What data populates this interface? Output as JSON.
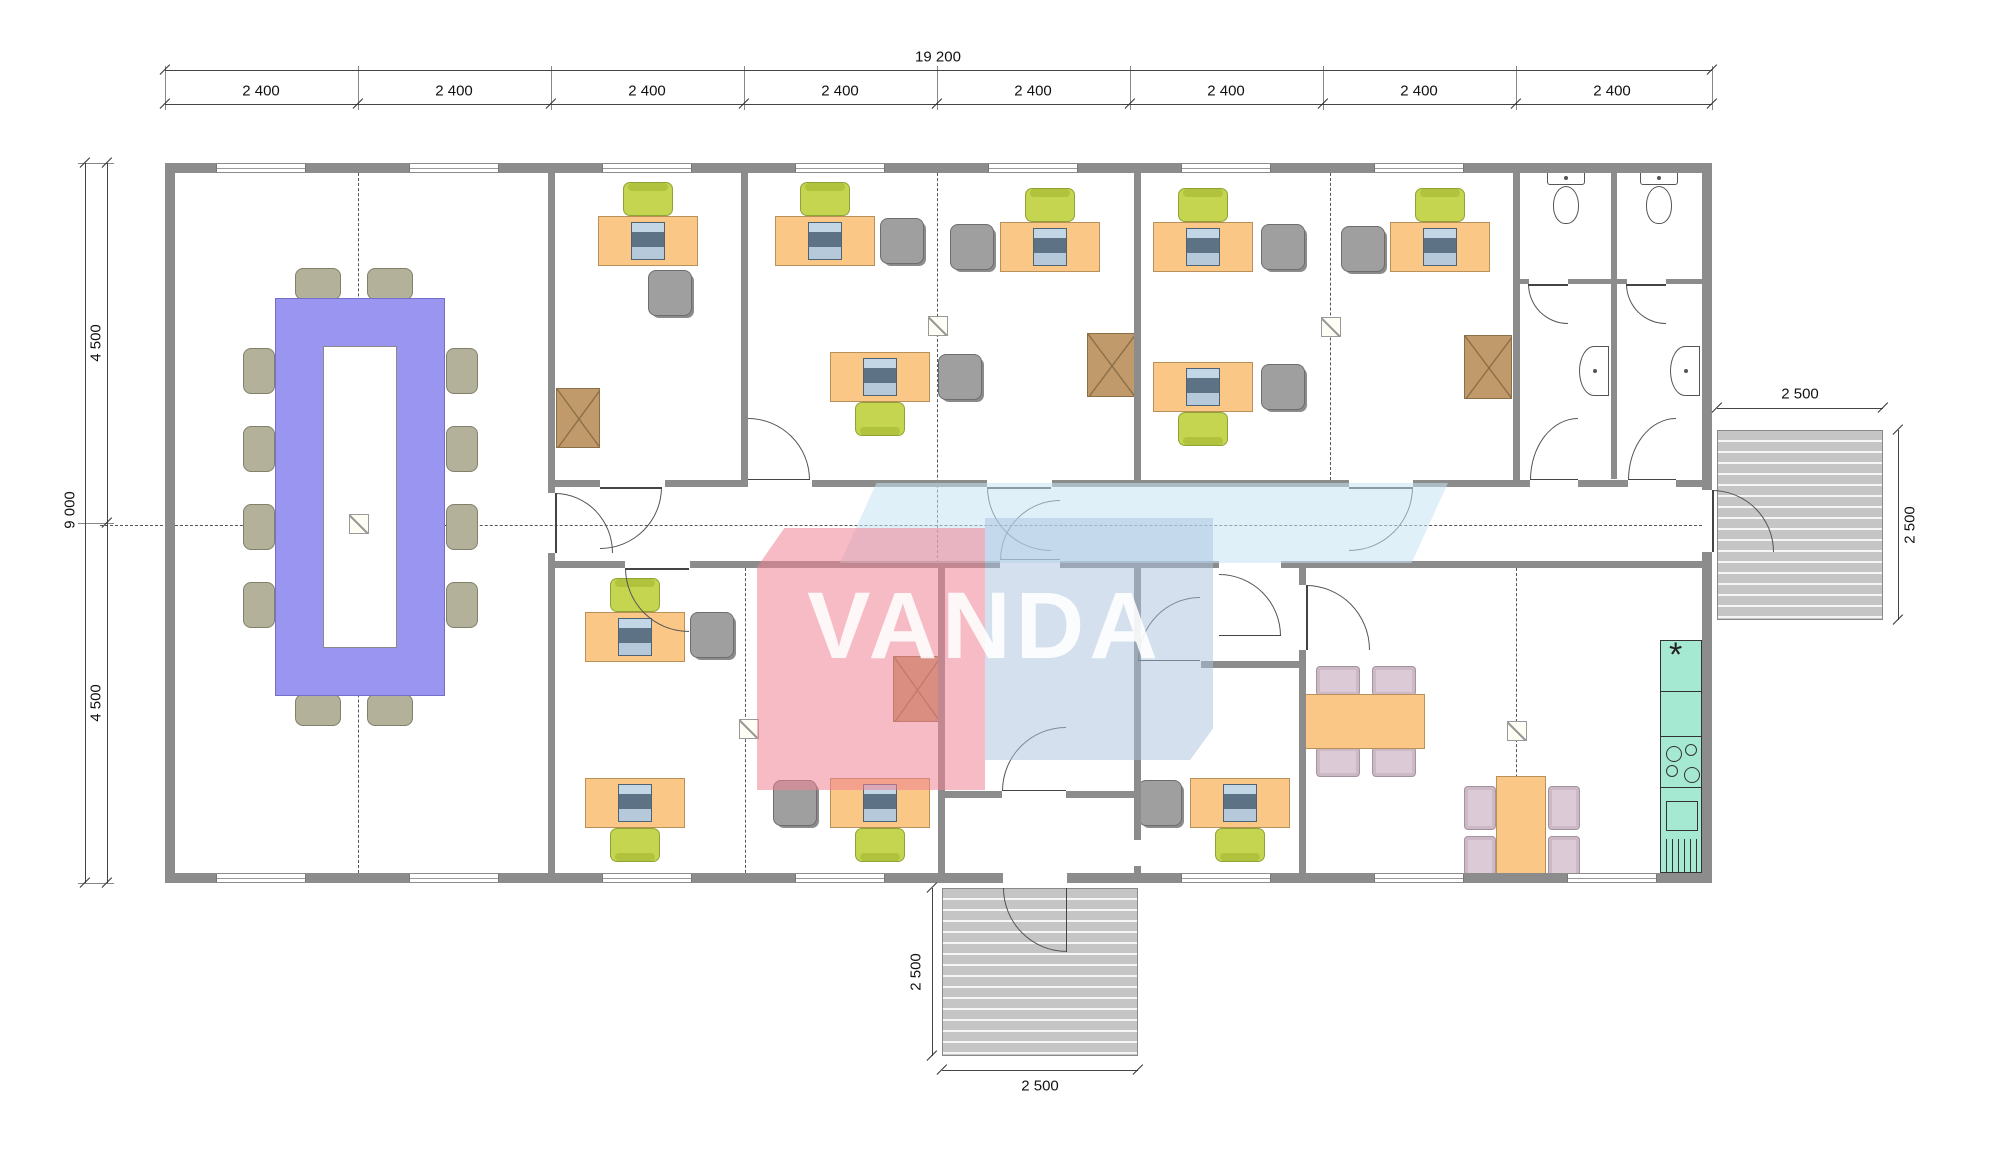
{
  "watermark": {
    "text": "VANDA",
    "accent_red": "#ef8494",
    "accent_blue": "#a9c2de",
    "accent_lightblue": "#c5e4f4"
  },
  "dimensions": {
    "top_total": "19 200",
    "top_segments": [
      "2 400",
      "2 400",
      "2 400",
      "2 400",
      "2 400",
      "2 400",
      "2 400",
      "2 400"
    ],
    "left_total": "9 000",
    "left_segments": [
      "4 500",
      "4 500"
    ],
    "right_porch_width": "2 500",
    "right_porch_depth": "2 500",
    "bottom_porch_depth": "2 500",
    "bottom_porch_width": "2 500",
    "labels": [
      {
        "text": "19 200",
        "x": 938,
        "y": 57,
        "rot": 0,
        "name": "dim-total-width"
      },
      {
        "text": "2 400",
        "x": 261,
        "y": 91,
        "rot": 0,
        "name": "dim-module"
      },
      {
        "text": "2 400",
        "x": 454,
        "y": 91,
        "rot": 0,
        "name": "dim-module"
      },
      {
        "text": "2 400",
        "x": 647,
        "y": 91,
        "rot": 0,
        "name": "dim-module"
      },
      {
        "text": "2 400",
        "x": 840,
        "y": 91,
        "rot": 0,
        "name": "dim-module"
      },
      {
        "text": "2 400",
        "x": 1033,
        "y": 91,
        "rot": 0,
        "name": "dim-module"
      },
      {
        "text": "2 400",
        "x": 1226,
        "y": 91,
        "rot": 0,
        "name": "dim-module"
      },
      {
        "text": "2 400",
        "x": 1419,
        "y": 91,
        "rot": 0,
        "name": "dim-module"
      },
      {
        "text": "2 400",
        "x": 1612,
        "y": 91,
        "rot": 0,
        "name": "dim-module"
      },
      {
        "text": "9 000",
        "x": 70,
        "y": 510,
        "rot": 1,
        "name": "dim-total-depth"
      },
      {
        "text": "4 500",
        "x": 96,
        "y": 343,
        "rot": 1,
        "name": "dim-half-depth"
      },
      {
        "text": "4 500",
        "x": 96,
        "y": 703,
        "rot": 1,
        "name": "dim-half-depth"
      },
      {
        "text": "2 500",
        "x": 1800,
        "y": 394,
        "rot": 0,
        "name": "dim-right-porch"
      },
      {
        "text": "2 500",
        "x": 1910,
        "y": 525,
        "rot": 1,
        "name": "dim-right-porch"
      },
      {
        "text": "2 500",
        "x": 916,
        "y": 972,
        "rot": 1,
        "name": "dim-bottom-porch"
      },
      {
        "text": "2 500",
        "x": 1040,
        "y": 1086,
        "rot": 0,
        "name": "dim-bottom-porch"
      }
    ],
    "lines": [
      {
        "x": 165,
        "y": 70,
        "len": 1547,
        "dir": "h",
        "ticks": [
          165,
          1712
        ]
      },
      {
        "x": 165,
        "y": 104,
        "len": 1547,
        "dir": "h",
        "ticks": [
          165,
          358,
          551,
          744,
          937,
          1130,
          1323,
          1516,
          1712
        ]
      },
      {
        "x": 85,
        "y": 163,
        "len": 720,
        "dir": "v",
        "ticks": [
          163,
          883
        ]
      },
      {
        "x": 107,
        "y": 163,
        "len": 720,
        "dir": "v",
        "ticks": [
          163,
          523,
          883
        ]
      },
      {
        "x": 1717,
        "y": 408,
        "len": 166,
        "dir": "h",
        "ticks": [
          1717,
          1883
        ]
      },
      {
        "x": 1898,
        "y": 430,
        "len": 190,
        "dir": "v",
        "ticks": [
          430,
          620
        ]
      },
      {
        "x": 932,
        "y": 888,
        "len": 168,
        "dir": "v",
        "ticks": [
          888,
          1056
        ]
      },
      {
        "x": 942,
        "y": 1070,
        "len": 196,
        "dir": "h",
        "ticks": [
          942,
          1138
        ]
      }
    ],
    "stubs_top_x": [
      165,
      358,
      551,
      744,
      937,
      1130,
      1323,
      1516,
      1712
    ],
    "stubs_left_y": [
      163,
      523,
      883
    ]
  },
  "plan": {
    "walls": [
      [
        165,
        163,
        1547,
        10
      ],
      [
        165,
        873,
        1547,
        10
      ],
      [
        165,
        163,
        10,
        720
      ],
      [
        1702,
        163,
        10,
        720
      ],
      [
        548,
        163,
        7,
        330
      ],
      [
        548,
        553,
        7,
        330
      ],
      [
        741,
        163,
        7,
        317
      ],
      [
        1134,
        163,
        7,
        317
      ],
      [
        1513,
        163,
        7,
        317
      ],
      [
        1611,
        163,
        6,
        316
      ],
      [
        555,
        480,
        45,
        7
      ],
      [
        665,
        480,
        83,
        7
      ],
      [
        812,
        480,
        175,
        7
      ],
      [
        1052,
        480,
        297,
        7
      ],
      [
        1413,
        480,
        117,
        7
      ],
      [
        1578,
        480,
        50,
        7
      ],
      [
        1676,
        480,
        36,
        7
      ],
      [
        555,
        561,
        70,
        7
      ],
      [
        690,
        561,
        310,
        7
      ],
      [
        1060,
        561,
        159,
        7
      ],
      [
        1281,
        561,
        431,
        7
      ],
      [
        938,
        568,
        7,
        315
      ],
      [
        1134,
        568,
        7,
        272
      ],
      [
        1134,
        866,
        7,
        17
      ],
      [
        1299,
        568,
        7,
        17
      ],
      [
        1299,
        650,
        7,
        233
      ],
      [
        1201,
        661,
        98,
        7
      ],
      [
        945,
        791,
        57,
        7
      ],
      [
        1066,
        791,
        68,
        7
      ],
      [
        1519,
        279,
        10,
        5
      ],
      [
        1568,
        279,
        43,
        5
      ],
      [
        1617,
        279,
        10,
        5
      ],
      [
        1666,
        279,
        45,
        5
      ]
    ],
    "gaps": [
      [
        1003,
        873,
        64,
        10
      ],
      [
        1702,
        490,
        10,
        62
      ]
    ],
    "window_w": 90,
    "windows_top": [
      216,
      409,
      602,
      795,
      988,
      1181,
      1374
    ],
    "windows_bottom": [
      216,
      409,
      602,
      795,
      1181,
      1374,
      1567
    ],
    "dashed": [
      [
        358,
        163,
        720,
        "v"
      ],
      [
        937,
        163,
        400,
        "v"
      ],
      [
        1330,
        163,
        317,
        "v"
      ],
      [
        745,
        568,
        315,
        "v"
      ],
      [
        1516,
        568,
        315,
        "v"
      ],
      [
        100,
        525,
        1612,
        "h"
      ]
    ],
    "markers": [
      [
        349,
        514
      ],
      [
        928,
        316
      ],
      [
        1321,
        317
      ],
      [
        739,
        719
      ],
      [
        1507,
        721
      ]
    ],
    "doors": [
      [
        555,
        493,
        58,
        60,
        "tr",
        "left"
      ],
      [
        600,
        487,
        62,
        62,
        "br",
        "top"
      ],
      [
        748,
        418,
        62,
        62,
        "tr",
        "bottom"
      ],
      [
        987,
        487,
        64,
        64,
        "bl",
        "top"
      ],
      [
        1349,
        487,
        64,
        64,
        "br",
        "top"
      ],
      [
        1530,
        418,
        48,
        62,
        "tl",
        "bottom"
      ],
      [
        1628,
        418,
        48,
        62,
        "tl",
        "bottom"
      ],
      [
        1003,
        888,
        64,
        64,
        "bl",
        "right"
      ],
      [
        1002,
        727,
        64,
        64,
        "tl",
        "bottom"
      ],
      [
        1138,
        597,
        62,
        64,
        "tl",
        "bottom"
      ],
      [
        1306,
        585,
        64,
        65,
        "tr",
        "left"
      ],
      [
        1712,
        490,
        62,
        62,
        "tr",
        "left"
      ],
      [
        625,
        568,
        64,
        64,
        "bl",
        "top"
      ],
      [
        1000,
        500,
        60,
        60,
        "tl",
        "bottom"
      ],
      [
        1219,
        574,
        62,
        62,
        "tr",
        "bottom"
      ],
      [
        1528,
        284,
        40,
        40,
        "bl",
        "top"
      ],
      [
        1626,
        284,
        40,
        40,
        "bl",
        "top"
      ]
    ],
    "desk_size": [
      100,
      50
    ],
    "desks": [
      [
        598,
        216
      ],
      [
        775,
        216
      ],
      [
        1000,
        222
      ],
      [
        1153,
        222
      ],
      [
        1390,
        222
      ],
      [
        830,
        352
      ],
      [
        1153,
        362
      ],
      [
        585,
        612
      ],
      [
        585,
        778
      ],
      [
        830,
        778
      ],
      [
        1190,
        778
      ]
    ],
    "green_chairs": [
      [
        623,
        182,
        "u"
      ],
      [
        800,
        182,
        "u"
      ],
      [
        1025,
        188,
        "u"
      ],
      [
        1178,
        188,
        "u"
      ],
      [
        1415,
        188,
        "u"
      ],
      [
        855,
        402,
        "d"
      ],
      [
        1178,
        412,
        "d"
      ],
      [
        610,
        578,
        "u"
      ],
      [
        610,
        828,
        "d"
      ],
      [
        855,
        828,
        "d"
      ],
      [
        1215,
        828,
        "d"
      ]
    ],
    "gray_chairs": [
      [
        648,
        270
      ],
      [
        880,
        218
      ],
      [
        950,
        224
      ],
      [
        1261,
        224
      ],
      [
        1341,
        226
      ],
      [
        938,
        354
      ],
      [
        1261,
        364
      ],
      [
        690,
        612
      ],
      [
        773,
        780
      ],
      [
        1138,
        780
      ]
    ],
    "cabinets": [
      [
        556,
        388,
        44,
        60
      ],
      [
        1087,
        333,
        48,
        64
      ],
      [
        1464,
        335,
        48,
        64
      ],
      [
        893,
        656,
        47,
        66
      ]
    ],
    "conference": {
      "outer": [
        275,
        298,
        170,
        398
      ],
      "inner": [
        323,
        346,
        74,
        302
      ],
      "chairs": [
        [
          295,
          268,
          46,
          32
        ],
        [
          367,
          268,
          46,
          32
        ],
        [
          295,
          694,
          46,
          32
        ],
        [
          367,
          694,
          46,
          32
        ],
        [
          243,
          348,
          32,
          46
        ],
        [
          243,
          426,
          32,
          46
        ],
        [
          243,
          504,
          32,
          46
        ],
        [
          243,
          582,
          32,
          46
        ],
        [
          446,
          348,
          32,
          46
        ],
        [
          446,
          426,
          32,
          46
        ],
        [
          446,
          504,
          32,
          46
        ],
        [
          446,
          582,
          32,
          46
        ]
      ]
    },
    "break_tables": [
      [
        1303,
        694,
        122,
        55
      ],
      [
        1496,
        776,
        50,
        104
      ]
    ],
    "pink_chairs": [
      [
        1316,
        666,
        44,
        30
      ],
      [
        1372,
        666,
        44,
        30
      ],
      [
        1316,
        747,
        44,
        30
      ],
      [
        1372,
        747,
        44,
        30
      ],
      [
        1464,
        786,
        32,
        44
      ],
      [
        1464,
        836,
        32,
        44
      ],
      [
        1548,
        786,
        32,
        44
      ],
      [
        1548,
        836,
        32,
        44
      ]
    ],
    "kitchen": {
      "counter": [
        1660,
        640,
        42,
        233
      ],
      "lines": [
        50,
        95,
        146
      ],
      "burners": [
        [
          5,
          105,
          16
        ],
        [
          24,
          103,
          12
        ],
        [
          5,
          124,
          12
        ],
        [
          23,
          126,
          16
        ]
      ],
      "sink": [
        5,
        160,
        32,
        30
      ],
      "hatch": [
        5,
        198,
        32,
        34
      ],
      "star_pos": [
        8,
        4
      ]
    },
    "toilets": [
      [
        1547,
        170
      ],
      [
        1640,
        170
      ]
    ],
    "sinks": [
      [
        1579,
        346
      ],
      [
        1670,
        346
      ]
    ],
    "decks": [
      [
        1717,
        430,
        166,
        190
      ],
      [
        942,
        888,
        196,
        168
      ]
    ]
  }
}
